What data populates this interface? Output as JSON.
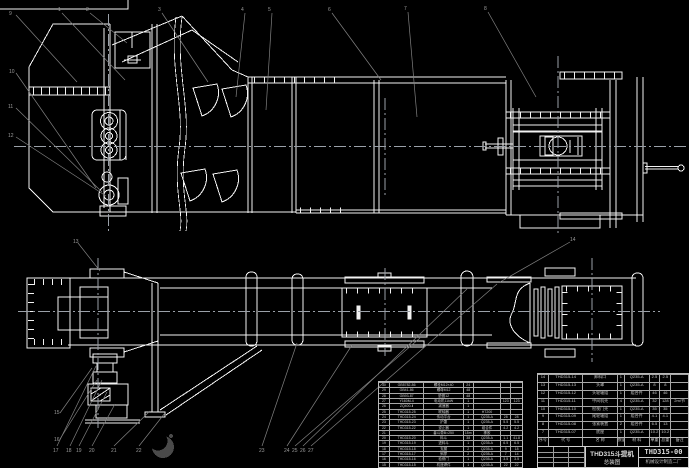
{
  "meta": {
    "background_color": "#000000",
    "line_color": "#f2f2f2",
    "leader_color": "#828282",
    "centerline_color": "#9aa0a8",
    "table_line_color": "#b9b9b9"
  },
  "title_block": {
    "product": "THD315斗提机",
    "drawing_name": "总装图",
    "drawing_no": "THD315-00",
    "company": "机械设计制造二厂"
  },
  "bom_right": {
    "headers": [
      "序号",
      "代 号",
      "名 称",
      "数量",
      "材 料",
      "单重",
      "总重",
      "备注"
    ],
    "rows": [
      [
        "14",
        "THD315-14",
        "卸料口",
        "1",
        "Q235-A",
        "2.5",
        "2.5",
        ""
      ],
      [
        "13",
        "THD315-13",
        "头罩",
        "1",
        "Q235-A",
        "8",
        "8",
        ""
      ],
      [
        "12",
        "THD315-12",
        "头轮轴组",
        "1",
        "组合件",
        "46",
        "46",
        ""
      ],
      [
        "11",
        "THD315-11",
        "中间机壳",
        "4",
        "Q235-A",
        "32",
        "128",
        "2m/节"
      ],
      [
        "10",
        "THD315-10",
        "检视门壳",
        "1",
        "Q235-A",
        "35",
        "35",
        ""
      ],
      [
        "9",
        "THD315-09",
        "尾轮轴组",
        "1",
        "组合件",
        "4.1",
        "4.1",
        ""
      ],
      [
        "8",
        "THD315-08",
        "张紧装置",
        "2",
        "组合件",
        "6.5",
        "13",
        ""
      ],
      [
        "7",
        "THD315-07",
        "底座",
        "1",
        "Q235-A",
        "10.2",
        "10.2",
        ""
      ]
    ]
  },
  "bom_left": {
    "rows": [
      [
        "30",
        "GB5782-86",
        "螺栓M12×40",
        "24",
        "",
        "",
        ""
      ],
      [
        "29",
        "GB41-86",
        "螺母M12",
        "48",
        "",
        "",
        ""
      ],
      [
        "28",
        "GB93-87",
        "垫圈12",
        "48",
        "",
        "",
        ""
      ],
      [
        "27",
        "Y160M-4",
        "电动机11kW",
        "1",
        "",
        "123",
        "123"
      ],
      [
        "26",
        "ZQ400-Ⅱ",
        "减速器",
        "1",
        "",
        "",
        ""
      ],
      [
        "25",
        "THD315-25",
        "联轴器",
        "1",
        "HT200",
        "",
        ""
      ],
      [
        "24",
        "THD315-24",
        "传动平台",
        "1",
        "Q235-A",
        "28",
        "28"
      ],
      [
        "23",
        "THD315-23",
        "护罩",
        "1",
        "Q235-A",
        "5.5",
        "5.5"
      ],
      [
        "22",
        "THD315-22",
        "逆止器",
        "1",
        "组合件",
        "4.2",
        "4.2"
      ],
      [
        "21",
        "",
        "畚斗带B=250",
        "15m",
        "橡胶",
        "",
        ""
      ],
      [
        "20",
        "THD315-20",
        "料斗",
        "38",
        "Q235-A",
        "1.1",
        "41.8"
      ],
      [
        "19",
        "THD315-19",
        "进料斗",
        "1",
        "Q235-A",
        "6.5",
        "6.5"
      ],
      [
        "18",
        "THD315-18",
        "支腿",
        "2",
        "Q235-A",
        "9",
        "18"
      ],
      [
        "17",
        "THD315-17",
        "斜撑",
        "2",
        "Q235-A",
        "7",
        "14"
      ],
      [
        "16",
        "THD315-16",
        "检修门",
        "1",
        "Q235-A",
        "3.5",
        "3.5"
      ],
      [
        "15",
        "THD315-15",
        "机座焊件",
        "1",
        "Q235-A",
        "22",
        "22"
      ]
    ]
  },
  "balloons": [
    "1",
    "2",
    "3",
    "4",
    "5",
    "6",
    "7",
    "8",
    "9",
    "10",
    "11",
    "12",
    "13",
    "14",
    "15",
    "16",
    "17",
    "18",
    "19",
    "20",
    "21",
    "22",
    "23",
    "24",
    "25",
    "26",
    "27"
  ]
}
